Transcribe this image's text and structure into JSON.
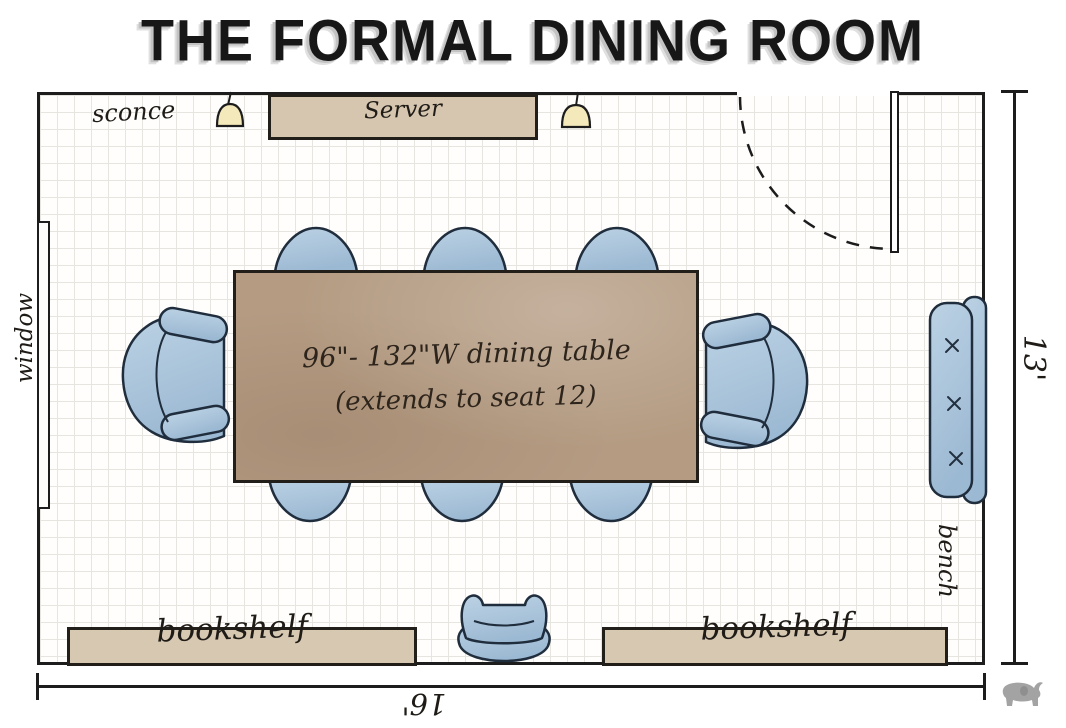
{
  "title": "THE FORMAL DINING ROOM",
  "labels": {
    "sconce": "sconce",
    "server": "Server",
    "window": "window",
    "bench": "bench",
    "bookshelf_left": "bookshelf",
    "bookshelf_right": "bookshelf"
  },
  "table": {
    "line1": "96\"- 132\"W dining table",
    "line2": "(extends to seat 12)"
  },
  "dimensions": {
    "depth": "13'",
    "width": "16'"
  },
  "furniture": {
    "side_chairs_top": 3,
    "side_chairs_bottom": 3,
    "end_armchairs": 2,
    "bench_seat_cushions": 3,
    "accent_chair": 1,
    "pendant_lights": 2,
    "bookshelves": 2,
    "server": 1,
    "window": 1,
    "door": 1
  },
  "colors": {
    "ink": "#1d1d1d",
    "chair_blue": "#a9c3da",
    "table_wood": "#b49b82",
    "shelf_tan": "#d7c8b2",
    "pendant_yellow": "#f3e9bb",
    "grid": "#e7e5e0",
    "title_shadow": "#c3c3c3",
    "logo_gray": "#a3a3a3"
  }
}
